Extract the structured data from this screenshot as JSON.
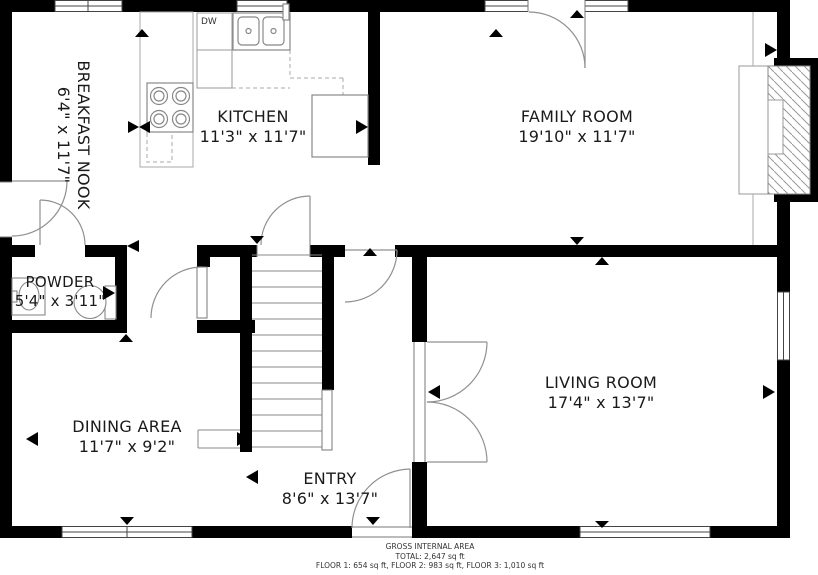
{
  "rooms": {
    "breakfast_nook": {
      "name": "BREAKFAST NOOK",
      "dims": "6'4\" x 11'7\""
    },
    "kitchen": {
      "name": "KITCHEN",
      "dims": "11'3\" x 11'7\"",
      "dw_label": "DW"
    },
    "family_room": {
      "name": "FAMILY ROOM",
      "dims": "19'10\" x 11'7\""
    },
    "powder": {
      "name": "POWDER",
      "dims": "5'4\" x 3'11\""
    },
    "dining_area": {
      "name": "DINING AREA",
      "dims": "11'7\" x 9'2\""
    },
    "entry": {
      "name": "ENTRY",
      "dims": "8'6\" x 13'7\""
    },
    "living_room": {
      "name": "LIVING ROOM",
      "dims": "17'4\" x 13'7\""
    }
  },
  "footer": {
    "line1": "GROSS INTERNAL AREA",
    "line2": "TOTAL: 2,647 sq ft",
    "line3": "FLOOR 1: 654 sq ft, FLOOR 2: 983 sq ft, FLOOR 3: 1,010 sq ft"
  },
  "colors": {
    "wall": "#000000",
    "line": "#8a8a8a",
    "text": "#1a1a1a"
  }
}
